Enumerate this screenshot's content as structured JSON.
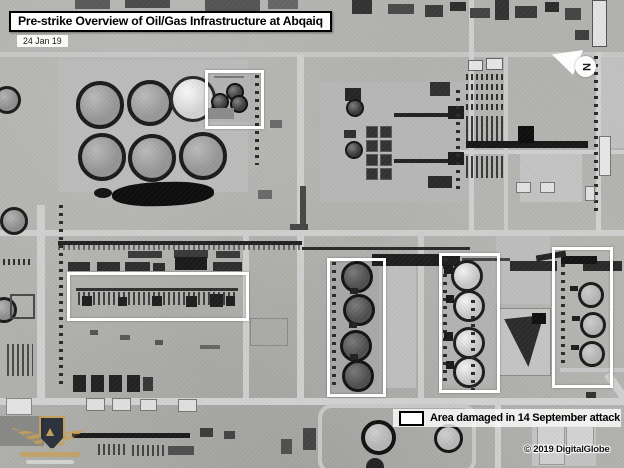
{
  "header": {
    "title": "Pre-strike Overview of Oil/Gas Infrastructure at Abqaiq",
    "date": "24 Jan 19"
  },
  "north": {
    "label": "N"
  },
  "legend": {
    "label": "Area damaged in 14 September attack"
  },
  "credit": {
    "text": "© 2019 DigitalGlobe"
  },
  "annotations": {
    "damage_areas": [
      {
        "x": 205,
        "y": 70,
        "w": 53,
        "h": 53
      },
      {
        "x": 67,
        "y": 272,
        "w": 176,
        "h": 43
      },
      {
        "x": 327,
        "y": 258,
        "w": 53,
        "h": 133
      },
      {
        "x": 439,
        "y": 253,
        "w": 55,
        "h": 134
      },
      {
        "x": 552,
        "y": 247,
        "w": 55,
        "h": 135
      }
    ]
  },
  "colors": {
    "annotation": "#ffffff",
    "ink": "#000000"
  }
}
